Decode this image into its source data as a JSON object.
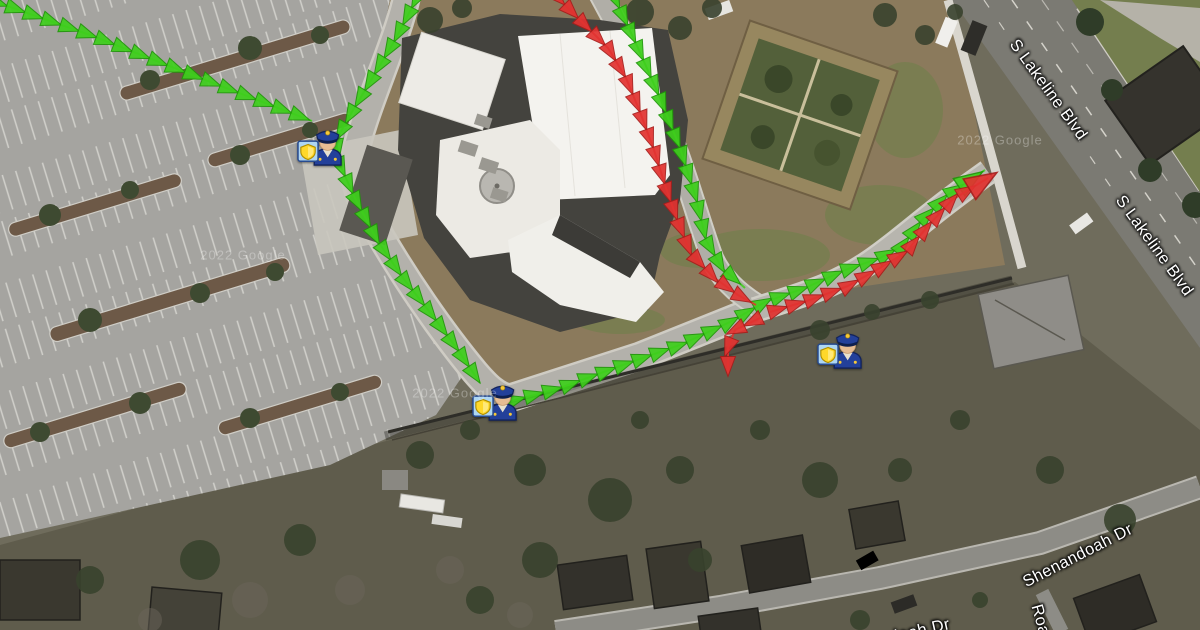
{
  "map": {
    "view": "satellite",
    "street_labels": [
      {
        "id": "s-lakeline-blvd-1",
        "text": "S Lakeline Blvd",
        "x": 1048,
        "y": 90,
        "rotation": 54
      },
      {
        "id": "s-lakeline-blvd-2",
        "text": "S Lakeline Blvd",
        "x": 1154,
        "y": 246,
        "rotation": 54
      },
      {
        "id": "shenandoah-dr-1",
        "text": "Shenandoah Dr",
        "x": 1078,
        "y": 556,
        "rotation": -27
      },
      {
        "id": "shenandoah-dr-2",
        "text": "Shenandoah Dr",
        "x": 891,
        "y": 638,
        "rotation": -13
      },
      {
        "id": "road-partial",
        "text": "Roa",
        "x": 1040,
        "y": 620,
        "rotation": 74
      }
    ],
    "watermarks": [
      {
        "text": "2022 Google",
        "x": 243,
        "y": 255
      },
      {
        "text": "2022 Google",
        "x": 455,
        "y": 393
      },
      {
        "text": "2022 Google",
        "x": 1000,
        "y": 140
      }
    ]
  },
  "markers": {
    "type": "police-officer",
    "officers": [
      {
        "id": "officer-northwest",
        "x": 320,
        "y": 143
      },
      {
        "id": "officer-south",
        "x": 495,
        "y": 398
      },
      {
        "id": "officer-east",
        "x": 840,
        "y": 346
      }
    ]
  },
  "routes": {
    "green": {
      "color": "#3ecf1c",
      "edge_color": "#1f9608",
      "paths": [
        {
          "id": "green-parking-lot-entry",
          "points": [
            [
              -10,
              0
            ],
            [
              90,
              35
            ],
            [
              200,
              78
            ],
            [
              312,
              121
            ]
          ]
        },
        {
          "id": "green-north-entry-west-drive",
          "points": [
            [
              420,
              -8
            ],
            [
              395,
              40
            ],
            [
              352,
              112
            ],
            [
              336,
              140
            ],
            [
              340,
              165
            ],
            [
              355,
              198
            ],
            [
              377,
              240
            ],
            [
              403,
              278
            ],
            [
              432,
              315
            ],
            [
              458,
              350
            ],
            [
              480,
              383
            ]
          ]
        },
        {
          "id": "green-fence-line-to-lakeline",
          "end_scale": 1.4,
          "points": [
            [
              508,
              402
            ],
            [
              560,
              388
            ],
            [
              620,
              366
            ],
            [
              680,
              345
            ],
            [
              730,
              322
            ],
            [
              765,
              302
            ],
            [
              805,
              288
            ],
            [
              845,
              270
            ],
            [
              880,
              258
            ],
            [
              902,
              246
            ],
            [
              922,
              220
            ],
            [
              946,
              196
            ],
            [
              985,
              170
            ]
          ]
        },
        {
          "id": "green-east-drive-outer",
          "points": [
            [
              612,
              -8
            ],
            [
              638,
              48
            ],
            [
              660,
              98
            ],
            [
              680,
              148
            ],
            [
              696,
              198
            ],
            [
              706,
              240
            ],
            [
              722,
              268
            ],
            [
              745,
              288
            ]
          ]
        }
      ]
    },
    "red": {
      "color": "#e23230",
      "edge_color": "#a81d1b",
      "paths": [
        {
          "id": "red-north-entry-east-drive",
          "points": [
            [
              552,
              -8
            ],
            [
              582,
              22
            ],
            [
              608,
              48
            ],
            [
              626,
              78
            ],
            [
              640,
              112
            ],
            [
              654,
              150
            ],
            [
              666,
              188
            ],
            [
              678,
              222
            ],
            [
              690,
              252
            ],
            [
              712,
              276
            ],
            [
              738,
              295
            ],
            [
              756,
              305
            ]
          ]
        },
        {
          "id": "red-exit-to-lakeline",
          "end_scale": 1.6,
          "points": [
            [
              770,
              312
            ],
            [
              810,
              300
            ],
            [
              848,
              286
            ],
            [
              880,
              268
            ],
            [
              906,
              252
            ],
            [
              928,
              226
            ],
            [
              952,
              200
            ],
            [
              988,
              178
            ]
          ]
        },
        {
          "id": "red-fence-crossing-stub",
          "points": [
            [
              760,
              318
            ],
            [
              735,
              330
            ],
            [
              728,
              348
            ],
            [
              728,
              372
            ]
          ]
        }
      ]
    }
  }
}
